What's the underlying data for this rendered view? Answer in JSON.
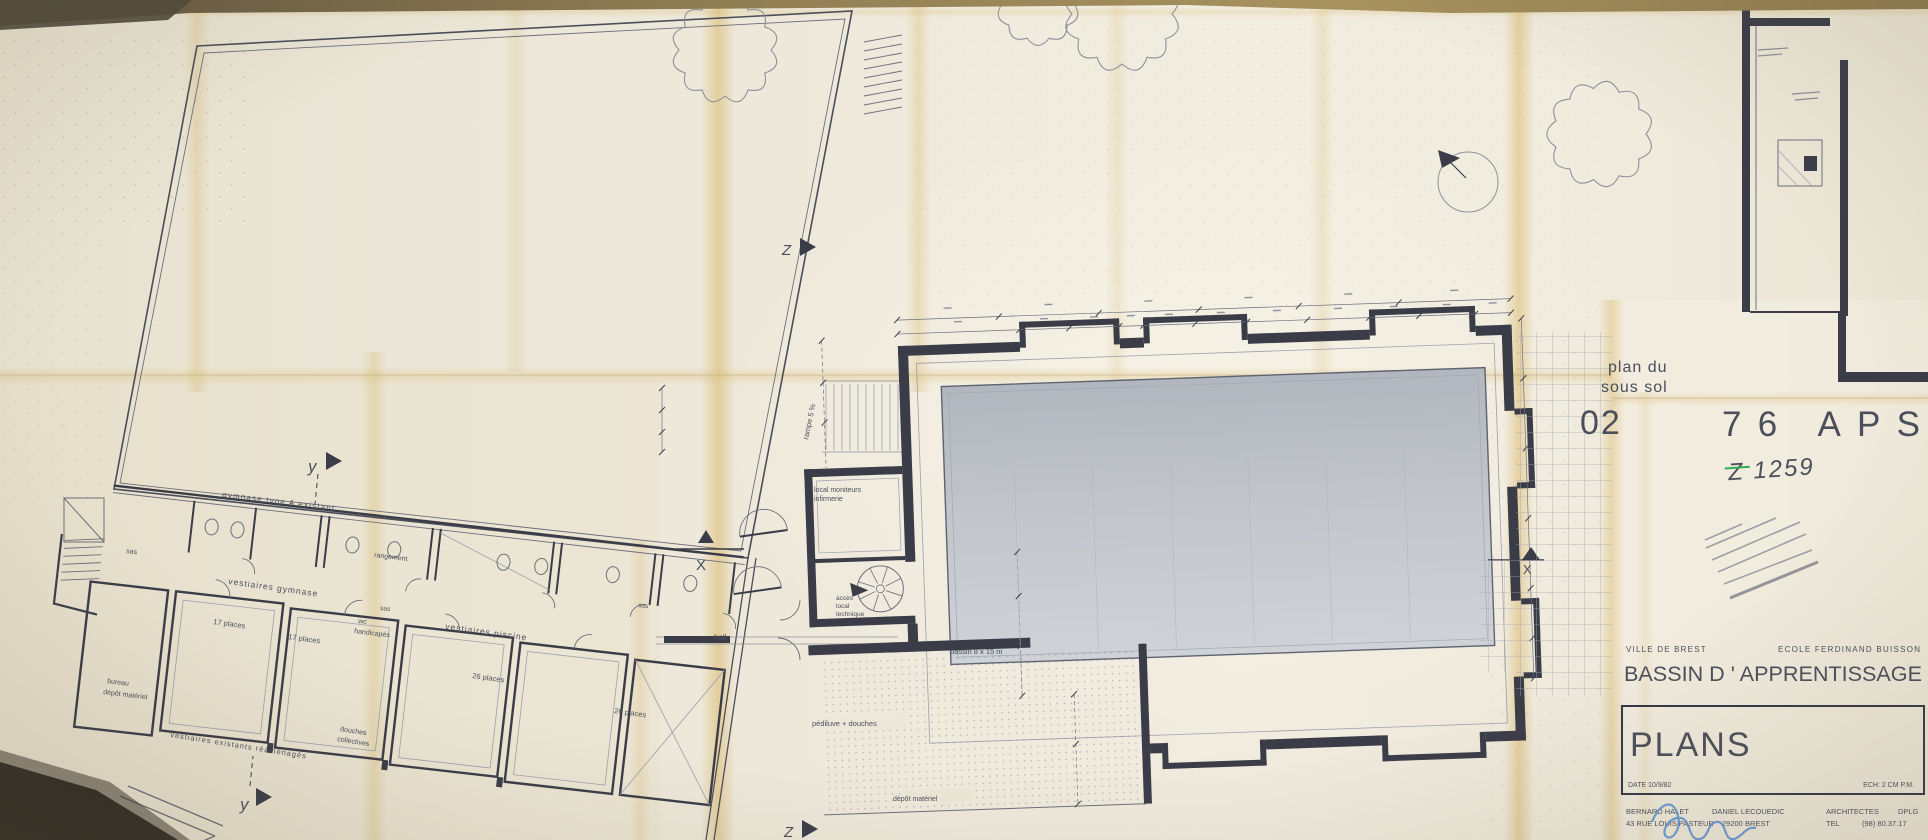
{
  "colors": {
    "paper": "#ece7d8",
    "ink": "#3a3c48",
    "ink_mid": "#6b6f7a",
    "ink_light": "#9aa0ab",
    "fold_stain": "#d6ae54",
    "pool_top": "#b4b8c0",
    "pool_bottom": "#cfd2d6",
    "green_note": "#2fae54",
    "signature_blue": "#5f93d6",
    "wall_background": "#8a7850"
  },
  "stamp": {
    "inset_caption": [
      "plan du",
      "sous sol"
    ],
    "sheet_number": "02",
    "project_code": "76 APS",
    "handwritten_ref": "Z 1259"
  },
  "title_block": {
    "client": "VILLE  DE  BREST",
    "school": "ECOLE  FERDINAND  BUISSON",
    "project_title": "BASSIN   D ' APPRENTISSAGE",
    "sheet_title": "PLANS",
    "date_label": "DATE  10/9/82",
    "scale_label": "ECH:  2 CM P.M.",
    "architect_1": "BERNARD  HALET",
    "architect_2": "DANIEL  LECOUEDIC",
    "address": "43  RUE  LOUIS  PASTEUR",
    "city": "29200  BREST",
    "architects_label": "ARCHITECTES",
    "diploma": "DPLG",
    "tel_label": "TEL",
    "phone": "(98)  80.37.17"
  },
  "plan_labels": [
    {
      "text": "gymnase  type  A   existant",
      "x": 222,
      "y": 497,
      "rot": 7,
      "s": 8,
      "ls": 1.2
    },
    {
      "text": "sas",
      "x": 126,
      "y": 553,
      "rot": 7,
      "s": 7
    },
    {
      "text": "vestiaires  gymnase",
      "x": 228,
      "y": 584,
      "rot": 8,
      "s": 8.5,
      "ls": 1
    },
    {
      "text": "17  places",
      "x": 213,
      "y": 624,
      "rot": 8,
      "s": 7.5
    },
    {
      "text": "17  places",
      "x": 288,
      "y": 639,
      "rot": 8,
      "s": 7.5
    },
    {
      "text": "rangement",
      "x": 374,
      "y": 557,
      "rot": 7,
      "s": 7
    },
    {
      "text": "sas",
      "x": 380,
      "y": 610,
      "rot": 6,
      "s": 6.5
    },
    {
      "text": "wc",
      "x": 358,
      "y": 623,
      "rot": 7,
      "s": 7
    },
    {
      "text": "handicapés",
      "x": 354,
      "y": 633,
      "rot": 7,
      "s": 7
    },
    {
      "text": "vestiaires  piscine",
      "x": 445,
      "y": 629,
      "rot": 8,
      "s": 8.5,
      "ls": 1
    },
    {
      "text": "26  places",
      "x": 472,
      "y": 678,
      "rot": 8,
      "s": 7.5
    },
    {
      "text": "26  places",
      "x": 614,
      "y": 713,
      "rot": 8,
      "s": 7.5
    },
    {
      "text": "sas",
      "x": 638,
      "y": 607,
      "rot": 6,
      "s": 6.5
    },
    {
      "text": "bureau",
      "x": 107,
      "y": 683,
      "rot": 7,
      "s": 7
    },
    {
      "text": "dépôt  matériel",
      "x": 103,
      "y": 694,
      "rot": 7,
      "s": 7
    },
    {
      "text": "vestiaires   existants   réaménagés",
      "x": 170,
      "y": 737,
      "rot": 9,
      "s": 7.5,
      "ls": 1
    },
    {
      "text": "douches",
      "x": 340,
      "y": 731,
      "rot": 9,
      "s": 7
    },
    {
      "text": "collectives",
      "x": 337,
      "y": 741,
      "rot": 9,
      "s": 7
    },
    {
      "text": "hall",
      "x": 714,
      "y": 640,
      "s": 8
    },
    {
      "text": "local  moniteurs",
      "x": 814,
      "y": 492,
      "s": 7
    },
    {
      "text": "infirmerie",
      "x": 814,
      "y": 501,
      "s": 7
    },
    {
      "text": "accès",
      "x": 836,
      "y": 600,
      "s": 6.5
    },
    {
      "text": "local",
      "x": 836,
      "y": 608,
      "s": 6.5
    },
    {
      "text": "technique",
      "x": 836,
      "y": 616,
      "s": 6.5
    },
    {
      "text": "pédiluve + douches",
      "x": 812,
      "y": 726,
      "s": 7.5
    },
    {
      "text": "dépôt  matériel",
      "x": 893,
      "y": 801,
      "s": 7
    },
    {
      "text": "bassin  8 x 15 m",
      "x": 950,
      "y": 654,
      "s": 7.5
    },
    {
      "text": "rampe  5 %",
      "x": 808,
      "y": 440,
      "rot": -78,
      "s": 7.5
    },
    {
      "text": "y",
      "x": 308,
      "y": 472,
      "s": 17,
      "c": "#33353f",
      "it": 1
    },
    {
      "text": "y",
      "x": 240,
      "y": 810,
      "s": 17,
      "c": "#33353f",
      "it": 1
    },
    {
      "text": "X",
      "x": 696,
      "y": 570,
      "s": 15,
      "c": "#33353f"
    },
    {
      "text": "X",
      "x": 1523,
      "y": 574,
      "s": 13,
      "c": "#33353f"
    },
    {
      "text": "Z",
      "x": 782,
      "y": 255,
      "s": 15,
      "c": "#33353f",
      "it": 1
    },
    {
      "text": "Z",
      "x": 784,
      "y": 837,
      "s": 15,
      "c": "#33353f",
      "it": 1
    }
  ]
}
